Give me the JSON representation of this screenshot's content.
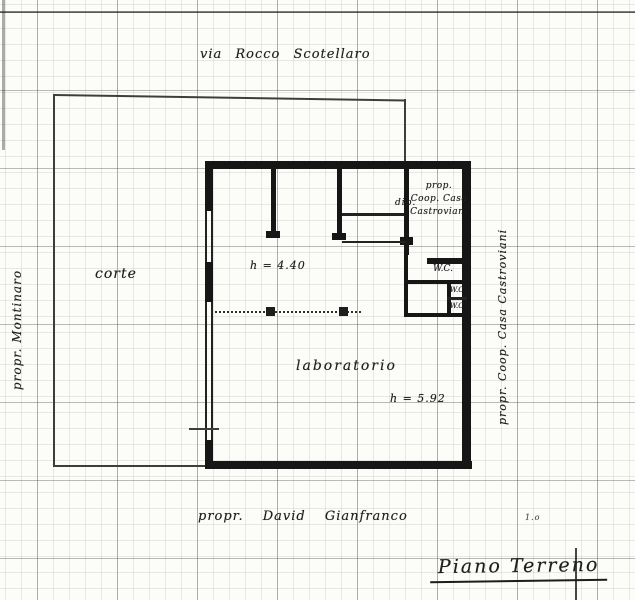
{
  "document": {
    "title": "Piano Terreno",
    "street": "via Rocco Scotellaro",
    "owners": {
      "left": "propr. Montinaro",
      "right": "propr. Coop. Casa Castroviani",
      "bottom": "propr. David Gianfranco"
    },
    "rooms": {
      "courtyard": "corte",
      "laboratory": "laboratorio",
      "coop_line1": "prop.",
      "coop_line2": "Coop. Casa",
      "coop_line3": "Castroviani",
      "coop_side": "dip.",
      "wc_main": "W.C.",
      "wc_small_top": "W.C.",
      "wc_small_bottom": "W.C."
    },
    "heights": {
      "courtyard_side": "h = 4.40",
      "laboratory": "h = 5.92"
    },
    "note": "1.o"
  },
  "colors": {
    "ink": "#1c1c1c",
    "paper": "#fcfcf9"
  }
}
